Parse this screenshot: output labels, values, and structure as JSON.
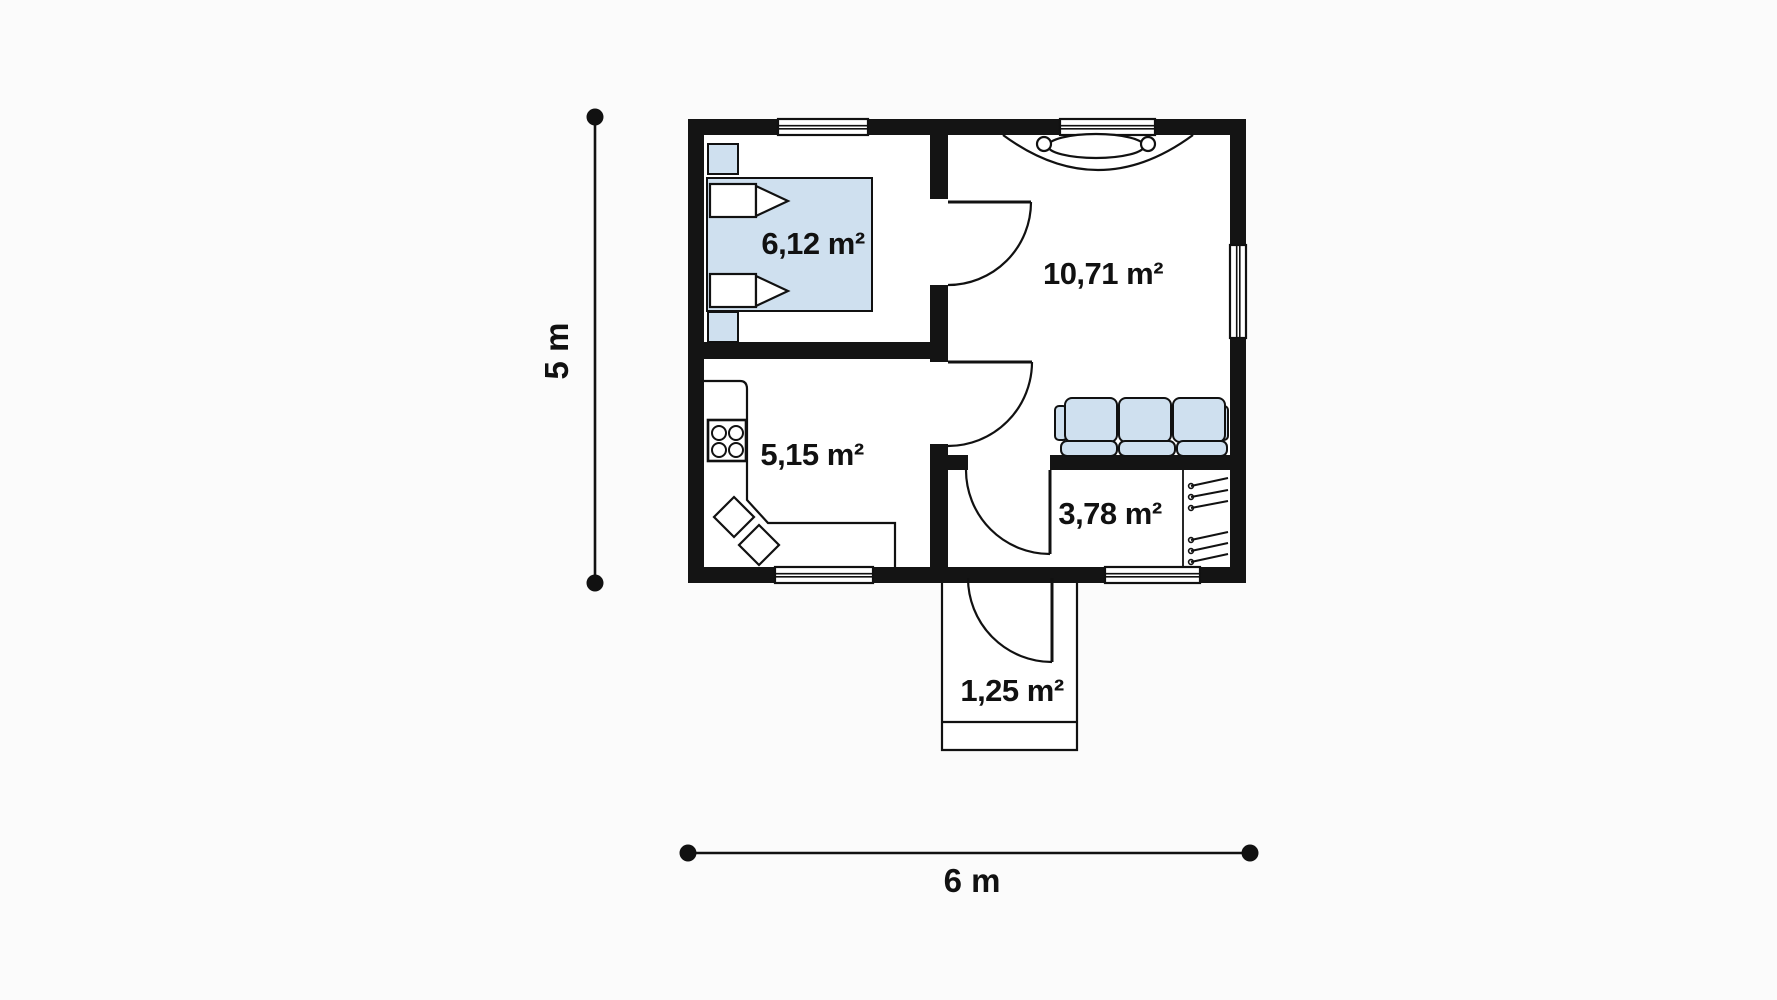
{
  "floor_plan": {
    "rooms": [
      {
        "name": "bedroom",
        "area_label": "6,12 m²"
      },
      {
        "name": "living-room",
        "area_label": "10,71 m²"
      },
      {
        "name": "kitchen",
        "area_label": "5,15 m²"
      },
      {
        "name": "bathroom",
        "area_label": "3,78 m²"
      },
      {
        "name": "porch",
        "area_label": "1,25 m²"
      }
    ],
    "dimensions": {
      "height_label": "5 m",
      "width_label": "6 m"
    },
    "furniture_symbols": [
      "double-bed",
      "pillow",
      "nightstand",
      "stove-burners",
      "kitchen-counter",
      "corner-sink",
      "sofa-three-seat",
      "wardrobe-hangers",
      "window-curtain",
      "door-swing"
    ],
    "colors": {
      "background": "#fbfbfb",
      "wall": "#141414",
      "furniture": "#cfe0ef",
      "ink": "#111111"
    }
  }
}
